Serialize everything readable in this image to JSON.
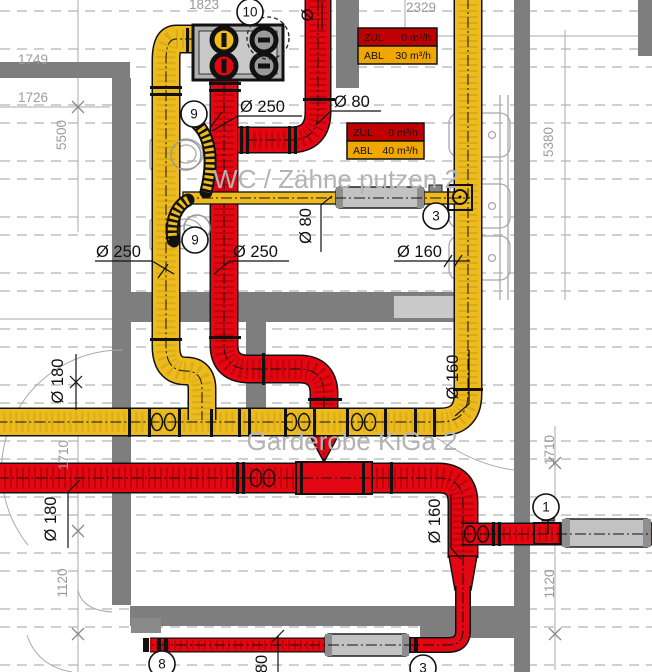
{
  "drawing": {
    "rooms": {
      "wc": "WC / Zähne putzen 2",
      "garderobe": "Garderobe KiGa 2"
    },
    "flow_boxes": {
      "box1": {
        "zul_label": "ZUL",
        "zul_value": "0 m³/h",
        "abl_label": "ABL",
        "abl_value": "30 m³/h"
      },
      "box2": {
        "zul_label": "ZUL",
        "zul_value": "0 m³/h",
        "abl_label": "ABL",
        "abl_value": "40 m³/h"
      }
    },
    "duct_labels": {
      "o250_top": "Ø 250",
      "o80_top": "Ø 80",
      "o250_left": "Ø 250",
      "o250_mid": "Ø 250",
      "o160_mid": "Ø 160",
      "o80_wc": "Ø 80",
      "o_partial_top": "Ø",
      "o160_right": "Ø 160",
      "o160_bottom_right": "Ø 160",
      "o180_left": "Ø 180",
      "o180_bottom_left": "Ø 180",
      "o80_bottom": "80"
    },
    "dimensions": {
      "top_left_partial": "1823",
      "top_mid": "2329",
      "left_1": "1749",
      "left_2": "1726",
      "left_v": "5500",
      "right_v": "5380",
      "left_mid": "1710",
      "left_low": "1120",
      "right_mid": "1710",
      "right_low": "1120"
    },
    "tags": {
      "unit": "10",
      "valve_top": "9",
      "valve_bottom": "9",
      "sil_wc": "3",
      "sil_right": "1",
      "duct_bottom": "8",
      "sil_bottom": "3"
    },
    "colors": {
      "supply": "#EDBB1E",
      "exhaust": "#E30613",
      "wall": "#7E7E7E",
      "zul_bg": "#C00000",
      "abl_bg": "#F0A800"
    }
  }
}
